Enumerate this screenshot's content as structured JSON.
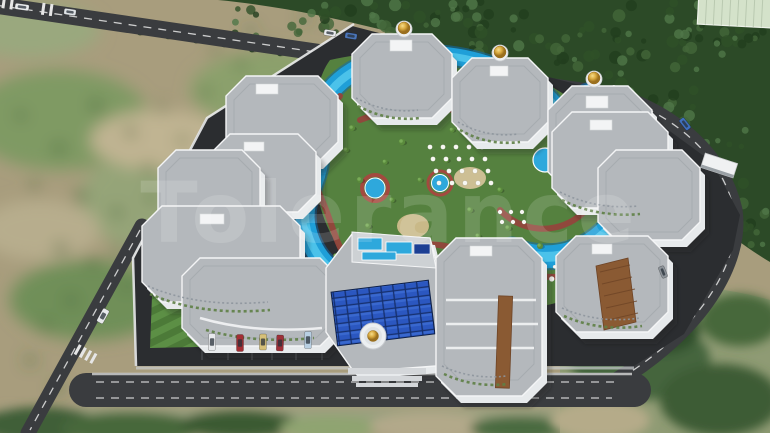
{
  "scene": {
    "watermark": "Tolerance"
  },
  "palette": {
    "field": "#a89d7d",
    "forest": "#2c4a27",
    "road": "#3a3c3f",
    "roadLine": "#e6e6e6",
    "asphalt": "#2b2d30",
    "roof": "#b4b8bc",
    "roofLight": "#cdd1d4",
    "wall": "#e7eaec",
    "white": "#f3f4f5",
    "poolBlue": "#1f9fd8",
    "poolDeep": "#0e6cae",
    "poolLight": "#5bcdf0",
    "pathRed": "#93453c",
    "green": "#55813f",
    "gold": "#d8a93f",
    "solar": "#2b57c0",
    "brown": "#8a5a33"
  },
  "cars": [
    [
      212,
      342,
      7,
      17,
      2,
      "#e8eaec"
    ],
    [
      240,
      343,
      7,
      17,
      0,
      "#a32e34"
    ],
    [
      263,
      342,
      7,
      16,
      1,
      "#d6c078"
    ],
    [
      280,
      343,
      7,
      16,
      2,
      "#9e3038"
    ],
    [
      308,
      340,
      7,
      17,
      1,
      "#b8cfe2"
    ],
    [
      103,
      316,
      7,
      15,
      29,
      "#e8eaec"
    ],
    [
      22,
      7,
      14,
      6,
      8,
      "#e9ebed"
    ],
    [
      70,
      12,
      12,
      6,
      8,
      "#dfe3e6"
    ],
    [
      330,
      33,
      12,
      6,
      9,
      "#e9ebed"
    ],
    [
      351,
      36,
      12,
      6,
      9,
      "#4a74b8"
    ],
    [
      685,
      124,
      13,
      6,
      52,
      "#3f6fbe"
    ],
    [
      663,
      272,
      12,
      6,
      68,
      "#8d9399"
    ]
  ],
  "decor": {
    "trees": {
      "field": {
        "color": "#3d6033",
        "hi": "#557e45",
        "pts": [
          [
            95,
            105,
            5
          ],
          [
            130,
            132,
            4.5
          ],
          [
            162,
            108,
            4
          ],
          [
            182,
            140,
            4
          ],
          [
            148,
            168,
            4.5
          ],
          [
            58,
            148,
            5
          ],
          [
            34,
            186,
            4
          ],
          [
            80,
            196,
            5
          ],
          [
            116,
            212,
            4.5
          ],
          [
            150,
            198,
            4
          ],
          [
            178,
            172,
            3.5
          ],
          [
            205,
            92,
            4
          ],
          [
            240,
            64,
            4
          ],
          [
            268,
            46,
            3.5
          ],
          [
            60,
            248,
            5
          ],
          [
            92,
            262,
            4.5
          ],
          [
            126,
            286,
            4
          ],
          [
            70,
            300,
            4.5
          ],
          [
            45,
            325,
            4
          ],
          [
            30,
            360,
            4
          ],
          [
            58,
            388,
            4.5
          ],
          [
            20,
            115,
            4
          ],
          [
            250,
            30,
            3.5
          ],
          [
            215,
            50,
            3.5
          ],
          [
            305,
            18,
            3.5
          ],
          [
            118,
            250,
            4
          ]
        ]
      },
      "roadside": {
        "color": "#2b4426",
        "hi": "#3d5c34",
        "pts": [
          [
            140,
            32,
            3.4
          ],
          [
            168,
            36,
            3.2
          ],
          [
            196,
            40,
            3.4
          ],
          [
            224,
            44,
            3.2
          ],
          [
            252,
            49,
            3.4
          ],
          [
            280,
            53,
            3.2
          ],
          [
            308,
            57,
            3.4
          ],
          [
            336,
            61,
            3.2
          ],
          [
            364,
            66,
            3.4
          ],
          [
            392,
            70,
            3.2
          ],
          [
            420,
            74,
            3.4
          ],
          [
            448,
            79,
            3.2
          ],
          [
            476,
            83,
            3.4
          ],
          [
            504,
            88,
            3.2
          ],
          [
            532,
            92,
            3.4
          ]
        ]
      },
      "rightstrip": {
        "color": "#33532c",
        "hi": "#46703c",
        "pts": [
          [
            648,
            138,
            3.6
          ],
          [
            658,
            162,
            3.4
          ],
          [
            666,
            188,
            3.6
          ],
          [
            671,
            214,
            3.4
          ],
          [
            668,
            240,
            3.6
          ],
          [
            658,
            263,
            3.4
          ],
          [
            700,
            252,
            3.4
          ],
          [
            690,
            282,
            3.6
          ]
        ]
      },
      "complex": {
        "color": "#5a8a3c",
        "hi": "#78ab57",
        "pts": [
          [
            352,
            128,
            3
          ],
          [
            368,
            226,
            3
          ],
          [
            402,
            142,
            3.2
          ],
          [
            470,
            210,
            3
          ],
          [
            508,
            228,
            3
          ],
          [
            540,
            246,
            3
          ],
          [
            430,
            120,
            3
          ],
          [
            360,
            180,
            3.2
          ],
          [
            392,
            200,
            2.8
          ],
          [
            446,
            160,
            3
          ],
          [
            520,
            140,
            3
          ],
          [
            560,
            160,
            3
          ],
          [
            500,
            190,
            2.8
          ],
          [
            478,
            236,
            2.8
          ],
          [
            420,
            240,
            3
          ],
          [
            336,
            256,
            2.8
          ],
          [
            346,
            150,
            2.8
          ],
          [
            420,
            180,
            2.6
          ],
          [
            385,
            162,
            2.6
          ],
          [
            452,
            130,
            2.6
          ]
        ]
      }
    },
    "forest_patches": [
      [
        235,
        0,
        270,
        36,
        40
      ],
      [
        430,
        4,
        210,
        62,
        42
      ],
      [
        560,
        30,
        140,
        110,
        40
      ],
      [
        625,
        125,
        145,
        125,
        40
      ],
      [
        656,
        0,
        114,
        56,
        28
      ]
    ],
    "forest_colors": [
      "#223d1e",
      "#44663a",
      "#2f5028",
      "#507748"
    ],
    "umbrella_arcs": [
      {
        "cx": 548,
        "cy": 172,
        "r": 107,
        "a0": -52,
        "a1": 122,
        "step": 7,
        "dot": 2.7
      },
      {
        "cx": 548,
        "cy": 172,
        "r": 95,
        "a0": -40,
        "a1": 115,
        "step": 6,
        "dot": 1.8
      }
    ],
    "umbrella_grids": [
      {
        "x": 430,
        "y": 147,
        "cols": 5,
        "rows": 4,
        "dx": 13,
        "dy": 12,
        "sx": 3,
        "dot": 2.4
      },
      {
        "x": 500,
        "y": 212,
        "cols": 3,
        "rows": 2,
        "dx": 11,
        "dy": 10,
        "sx": 2,
        "dot": 2.2
      }
    ]
  }
}
